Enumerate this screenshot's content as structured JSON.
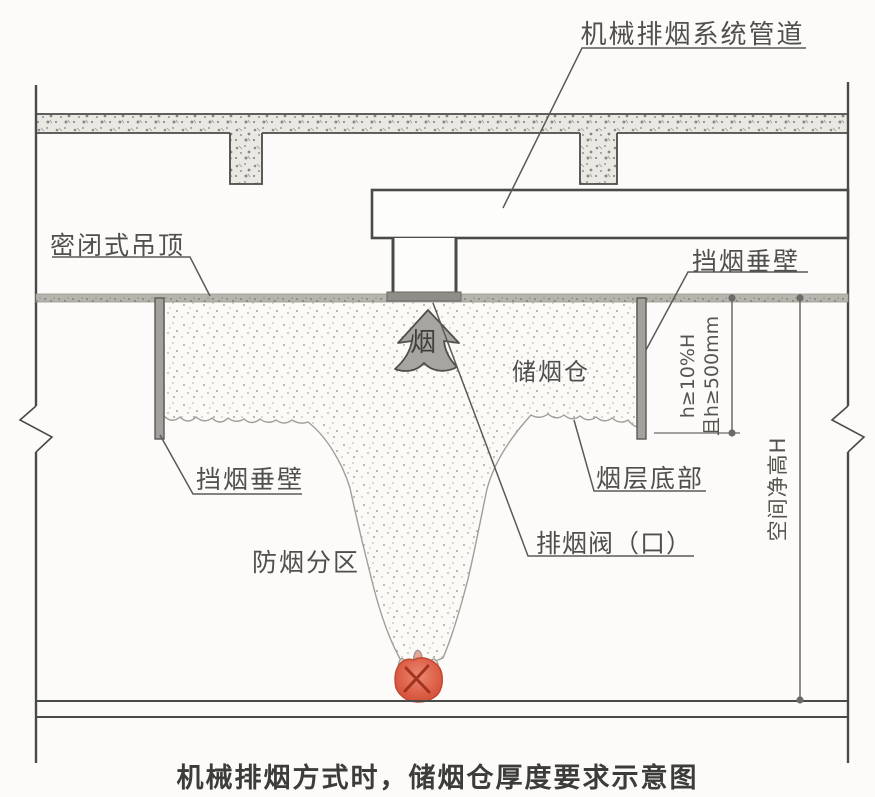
{
  "caption": "机械排烟方式时，储烟仓厚度要求示意图",
  "labels": {
    "duct": "机械排烟系统管道",
    "sealed_ceiling": "密闭式吊顶",
    "barrier_right": "挡烟垂壁",
    "barrier_left": "挡烟垂壁",
    "smoke_reservoir": "储烟仓",
    "smoke_layer_bottom": "烟层底部",
    "exhaust_valve": "排烟阀（口）",
    "smoke_zone": "防烟分区",
    "smoke": "烟"
  },
  "dimensions": {
    "reservoir_depth_line1": "h≥10%H",
    "reservoir_depth_line2": "且h≥500mm",
    "clear_height": "空间净高H"
  },
  "colors": {
    "line": "#4a4a48",
    "label_text": "#4f4f4c",
    "gray_fill": "#a7a5a0",
    "ceiling_gray": "#b6b4ad",
    "fire_red": "#dd5f47"
  }
}
